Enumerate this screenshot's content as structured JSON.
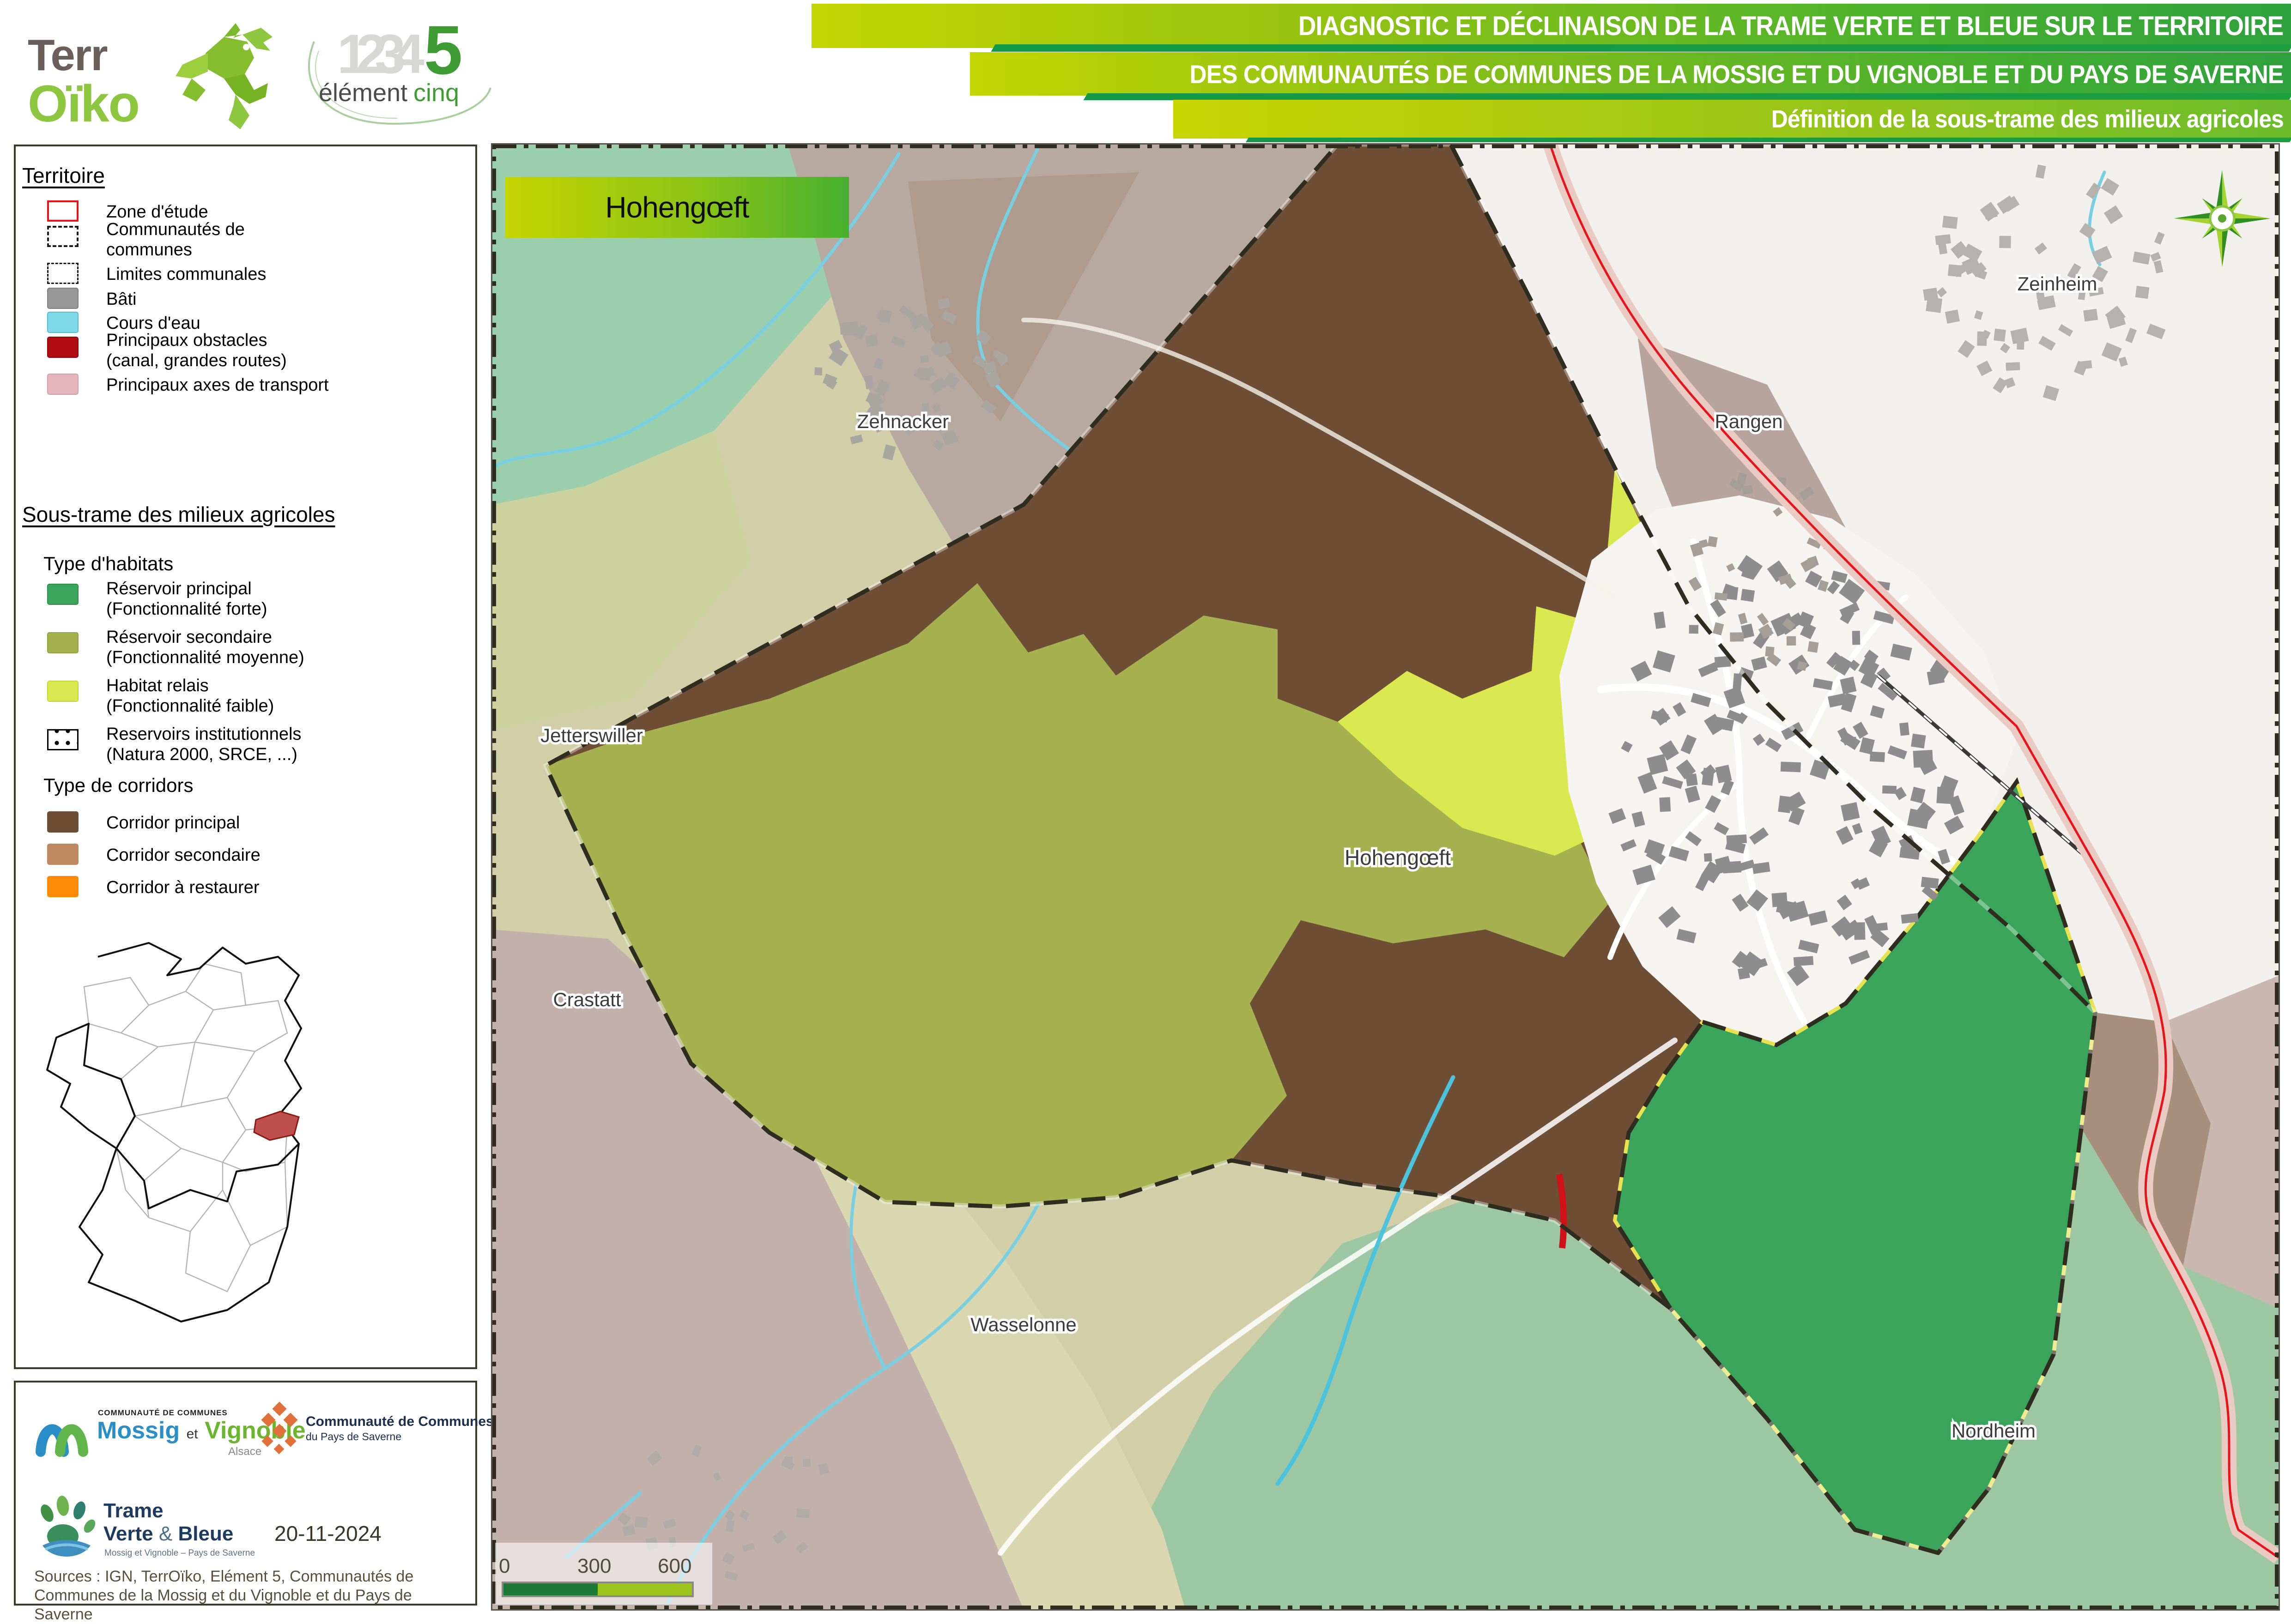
{
  "header": {
    "logo_terroiko": {
      "terr": "Terr",
      "oiko": "Oïko"
    },
    "logo_element5": {
      "numbers": "1234",
      "five": "5",
      "element": "élément",
      "cinq": "cinq"
    },
    "banners": {
      "line1": "DIAGNOSTIC ET DÉCLINAISON DE LA TRAME VERTE ET BLEUE SUR LE TERRITOIRE",
      "line2": "DES COMMUNAUTÉS DE COMMUNES DE LA MOSSIG ET DU VIGNOBLE ET DU PAYS DE SAVERNE",
      "line3": "Définition de la sous-trame des milieux agricoles"
    }
  },
  "legend": {
    "territoire": {
      "title": "Territoire",
      "items": [
        {
          "label": "Zone d'étude"
        },
        {
          "label": "Communautés de",
          "label2": "communes"
        },
        {
          "label": "Limites communales"
        },
        {
          "label": "Bâti"
        },
        {
          "label": "Cours d'eau"
        },
        {
          "label": "Principaux obstacles",
          "label2": "(canal, grandes routes)"
        },
        {
          "label": "Principaux axes de transport"
        }
      ]
    },
    "soustrame": {
      "title": "Sous-trame des milieux agricoles",
      "habitats_title": "Type d'habitats",
      "habitats": [
        {
          "label": "Réservoir principal",
          "label2": "(Fonctionnalité forte)",
          "color": "#3aa45a"
        },
        {
          "label": "Réservoir secondaire",
          "label2": "(Fonctionnalité moyenne)",
          "color": "#a5b14e"
        },
        {
          "label": "Habitat relais",
          "label2": "(Fonctionnalité faible)",
          "color": "#d9e84f"
        },
        {
          "label": "Reservoirs institutionnels",
          "label2": "(Natura 2000, SRCE, ...)",
          "color": "dotted"
        }
      ],
      "corridors_title": "Type de corridors",
      "corridors": [
        {
          "label": "Corridor principal",
          "color": "#6f4e36"
        },
        {
          "label": "Corridor secondaire",
          "color": "#bf8a62"
        },
        {
          "label": "Corridor à restaurer",
          "color": "#ff8b07"
        }
      ]
    }
  },
  "map": {
    "title_box": "Hohengœft",
    "place_labels": [
      "Zehnacker",
      "Zeinheim",
      "Rangen",
      "Jetterswiller",
      "Crastatt",
      "Hohengœft",
      "Wasselonne",
      "Nordheim"
    ],
    "scalebar": {
      "t0": "0",
      "t300": "300",
      "t600": "600 m"
    },
    "colors": {
      "reservoir_principal": "#3aa45a",
      "reservoir_secondaire": "#a5b14e",
      "habitat_relais": "#d9e84f",
      "corridor_principal": "#6f4e36",
      "corridor_secondaire": "#bf8a62",
      "corridor_a_restaurer": "#ff8b07",
      "cours_eau": "#7fd9e8",
      "zone_etude_line": "#e8141b",
      "bati": "#979797",
      "fond_exterieur": "#d2cfa8",
      "boundary_dash": "#2f2d1f"
    }
  },
  "footer": {
    "logo_mossig": {
      "small": "COMMUNAUTÉ DE COMMUNES",
      "name1": "Mossig",
      "et": "et",
      "name2": "Vignoble",
      "region": "Alsace"
    },
    "logo_saverne": {
      "line1": "Communauté de Communes",
      "line2": "du Pays de Saverne"
    },
    "logo_tvb": {
      "line1": "Trame",
      "line2a": "Verte",
      "amp": "&",
      "line2b": "Bleue",
      "sub": "Mossig et Vignoble – Pays de Saverne"
    },
    "date": "20-11-2024",
    "sources": "Sources : IGN, TerrOïko, Elément 5, Communautés de Communes de la Mossig et du Vignoble et du Pays de Saverne"
  }
}
